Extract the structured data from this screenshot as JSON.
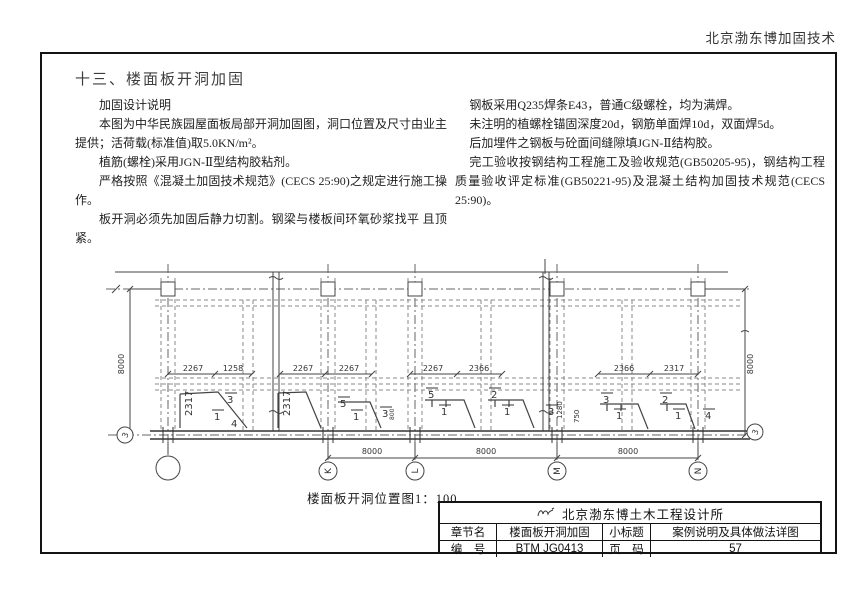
{
  "page": {
    "header": "北京渤东博加固技术",
    "section_title": "十三、楼面板开洞加固"
  },
  "notes_left": {
    "heading": "加固设计说明",
    "p1": "本图为中华民族园屋面板局部开洞加固图，洞口位置及尺寸由业主提供；活荷载(标准值)取5.0KN/m²。",
    "p2": "植筋(螺栓)采用JGN-Ⅱ型结构胶粘剂。",
    "p3": "严格按照《混凝土加固技术规范》(CECS 25:90)之规定进行施工操作。",
    "p4": "板开洞必须先加固后静力切割。钢梁与楼板间环氧砂浆找平 且顶紧。"
  },
  "notes_right": {
    "p1": "钢板采用Q235焊条E43，普通C级螺栓，均为满焊。",
    "p2": "未注明的植螺栓锚固深度20d，钢筋单面焊10d，双面焊5d。",
    "p3": "后加埋件之钢板与砼面间缝隙填JGN-Ⅱ结构胶。",
    "p4": "完工验收按钢结构工程施工及验收规范(GB50205-95)，钢结构工程质量验收评定标准(GB50221-95)及混凝土结构加固技术规范(CECS 25:90)。"
  },
  "drawing": {
    "caption": "楼面板开洞位置图1：100",
    "h_dims": [
      "2267",
      "1258",
      "2267",
      "2267",
      "2267",
      "2366",
      "2366",
      "2317"
    ],
    "span_dims": [
      "8000",
      "8000",
      "8000"
    ],
    "v_dim_left": "8000",
    "v_dim_right": "8000",
    "axis_bubbles": [
      "K",
      "L",
      "M",
      "N"
    ],
    "side_axis_left": "3",
    "side_axis_right": "3",
    "marks": [
      {
        "v": "2317",
        "x": 92,
        "y": 164,
        "r": -90
      },
      {
        "v": "3",
        "x": 127,
        "y": 151,
        "bar": true
      },
      {
        "v": "1",
        "x": 114,
        "y": 168,
        "bar": true
      },
      {
        "v": "4",
        "x": 131,
        "y": 175
      },
      {
        "v": "2317",
        "x": 190,
        "y": 164,
        "r": -90
      },
      {
        "v": "5",
        "x": 240,
        "y": 155,
        "bar": true
      },
      {
        "v": "1",
        "x": 253,
        "y": 168,
        "bar": true
      },
      {
        "v": "800",
        "x": 294,
        "y": 168,
        "r": -90,
        "s": 6
      },
      {
        "v": "3",
        "x": 282,
        "y": 165,
        "bar": true
      },
      {
        "v": "5",
        "x": 328,
        "y": 146,
        "bar": true
      },
      {
        "v": "1",
        "x": 341,
        "y": 163,
        "bar": true
      },
      {
        "v": "2",
        "x": 391,
        "y": 146,
        "bar": true
      },
      {
        "v": "1",
        "x": 404,
        "y": 163,
        "bar": true
      },
      {
        "v": "3",
        "x": 448,
        "y": 163,
        "bar": true
      },
      {
        "v": "1280",
        "x": 462,
        "y": 167,
        "r": -90,
        "s": 7
      },
      {
        "v": "750",
        "x": 479,
        "y": 171,
        "r": -90,
        "s": 7
      },
      {
        "v": "3",
        "x": 503,
        "y": 151,
        "bar": true
      },
      {
        "v": "1",
        "x": 516,
        "y": 167,
        "bar": true
      },
      {
        "v": "2",
        "x": 562,
        "y": 151,
        "bar": true
      },
      {
        "v": "1",
        "x": 575,
        "y": 167,
        "bar": true
      },
      {
        "v": "4",
        "x": 605,
        "y": 167,
        "bar": true
      }
    ]
  },
  "title_block": {
    "company": "北京渤东博土木工程设计所",
    "row1": {
      "label1": "章节名",
      "value1": "楼面板开洞加固",
      "label2": "小标题",
      "value2": "案例说明及具体做法详图"
    },
    "row2": {
      "label1": "编　号",
      "value1": "BTM JG0413",
      "label2": "页　码",
      "value2": "57"
    }
  }
}
